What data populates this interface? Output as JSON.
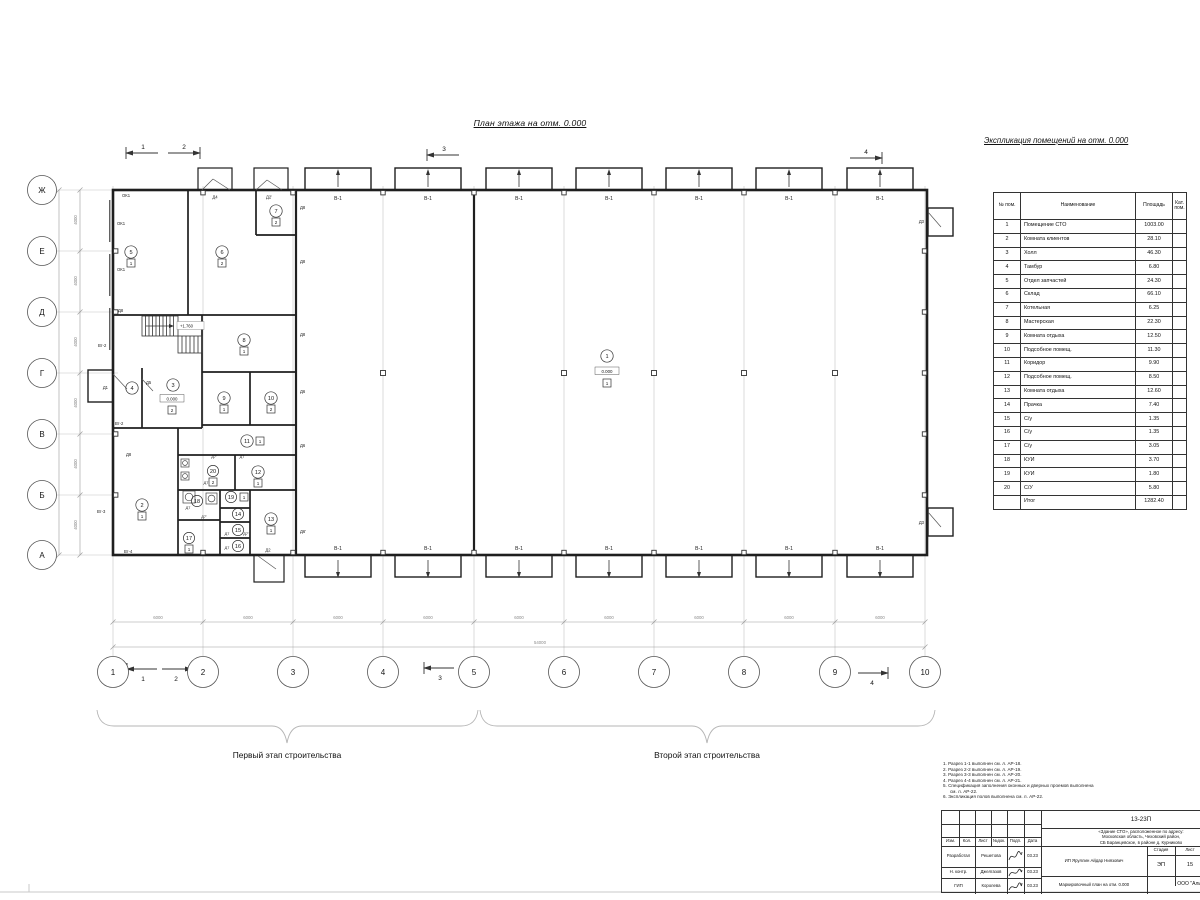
{
  "titles": {
    "plan": "План этажа на отм. 0.000",
    "explication": "Экспликация помещений на отм. 0.000"
  },
  "explication": {
    "headers": {
      "num": "№ пом.",
      "name": "Наименование",
      "area": "Площадь",
      "cat": "Кат. пом."
    },
    "rows": [
      {
        "num": "1",
        "name": "Помещение СТО",
        "area": "1003.00"
      },
      {
        "num": "2",
        "name": "Комната клиентов",
        "area": "28.10"
      },
      {
        "num": "3",
        "name": "Холл",
        "area": "46.30"
      },
      {
        "num": "4",
        "name": "Тамбур",
        "area": "6.80"
      },
      {
        "num": "5",
        "name": "Отдел запчастей",
        "area": "24.30"
      },
      {
        "num": "6",
        "name": "Склад",
        "area": "66.10"
      },
      {
        "num": "7",
        "name": "Котельная",
        "area": "6.25"
      },
      {
        "num": "8",
        "name": "Мастерская",
        "area": "22.30"
      },
      {
        "num": "9",
        "name": "Комната отдыха",
        "area": "12.50"
      },
      {
        "num": "10",
        "name": "Подсобное помещ.",
        "area": "11.30"
      },
      {
        "num": "11",
        "name": "Коридор",
        "area": "9.90"
      },
      {
        "num": "12",
        "name": "Подсобное помещ.",
        "area": "8.50"
      },
      {
        "num": "13",
        "name": "Комната отдыха",
        "area": "12.60"
      },
      {
        "num": "14",
        "name": "Прачка",
        "area": "7.40"
      },
      {
        "num": "15",
        "name": "С/у",
        "area": "1.35"
      },
      {
        "num": "16",
        "name": "С/у",
        "area": "1.35"
      },
      {
        "num": "17",
        "name": "С/у",
        "area": "3.05"
      },
      {
        "num": "18",
        "name": "КУИ",
        "area": "3.70"
      },
      {
        "num": "19",
        "name": "КУИ",
        "area": "1.80"
      },
      {
        "num": "20",
        "name": "С/У",
        "area": "5.80"
      }
    ],
    "total_label": "Итог",
    "total_area": "1282.40"
  },
  "plan": {
    "axes_x": [
      "1",
      "2",
      "3",
      "4",
      "5",
      "6",
      "7",
      "8",
      "9",
      "10"
    ],
    "axes_y": [
      "Ж",
      "Е",
      "Д",
      "Г",
      "В",
      "Б",
      "А"
    ],
    "dims": {
      "bay_x": "6000",
      "total_x": "54000",
      "bay_y": "4000",
      "total_y": "24000"
    },
    "labels": {
      "gate": "В-1",
      "window": "ОК1",
      "d1": "Д1",
      "d2": "Д2",
      "d2a": "Д2'",
      "d3": "Д3",
      "d4": "Д4",
      "d5": "Д5",
      "d6": "Д6",
      "d6a": "Д6'",
      "d7": "Д7",
      "d7a": "Д7'",
      "d8": "Д8",
      "vt2": "Вт-2",
      "vt3": "Вт-3",
      "vt4": "Вт-4"
    },
    "levels": {
      "zero": "0.000",
      "stairs": "+1.760"
    },
    "sections": [
      "1",
      "2",
      "3",
      "4"
    ],
    "floor_tags": {
      "t1": "1",
      "t2": "2"
    }
  },
  "stages": {
    "first": "Первый этап строительства",
    "second": "Второй этап строительства"
  },
  "notes": [
    "1. Разрез 1-1 выполнен см. л. АР-18.",
    "2. Разрез 2-2 выполнен см. л. АР-19.",
    "3. Разрез 3-3 выполнен см. л. АР-20.",
    "4. Разрез 4-4 выполнен см. л. АР-21.",
    "5. Спецификация заполнения оконных и дверных проемов выполнена см. л. АР-22.",
    "6. Экспликация полов выполнена см. л. АР-22."
  ],
  "titleblock": {
    "doc_number": "13-23П",
    "object_line1": "«Здание СТО», расположенное по адресу:",
    "object_line2": "Московская область, Чеховский район,",
    "object_line3": "СБ Баранцевское, в районе д. Курниково",
    "cols": {
      "izm": "Изм.",
      "kol": "Кол.",
      "list": "Лист",
      "ndoc": "№док.",
      "podp": "Подп.",
      "data": "Дата"
    },
    "rows": [
      {
        "role": "Разработал",
        "name": "Решетова",
        "date": "03.23"
      },
      {
        "role": "Н. контр.",
        "name": "Джелгазов",
        "date": "03.23"
      },
      {
        "role": "ГИП",
        "name": "Королева",
        "date": "03.23"
      }
    ],
    "client": "ИП Яруллин Айдар Ниязович",
    "stage_label": "Стадия",
    "sheet_label": "Лист",
    "stage": "ЭП",
    "sheet": "15",
    "plan_name": "Маркировочный план на отм. 0.000",
    "company": "ООО \"Альянс\""
  }
}
